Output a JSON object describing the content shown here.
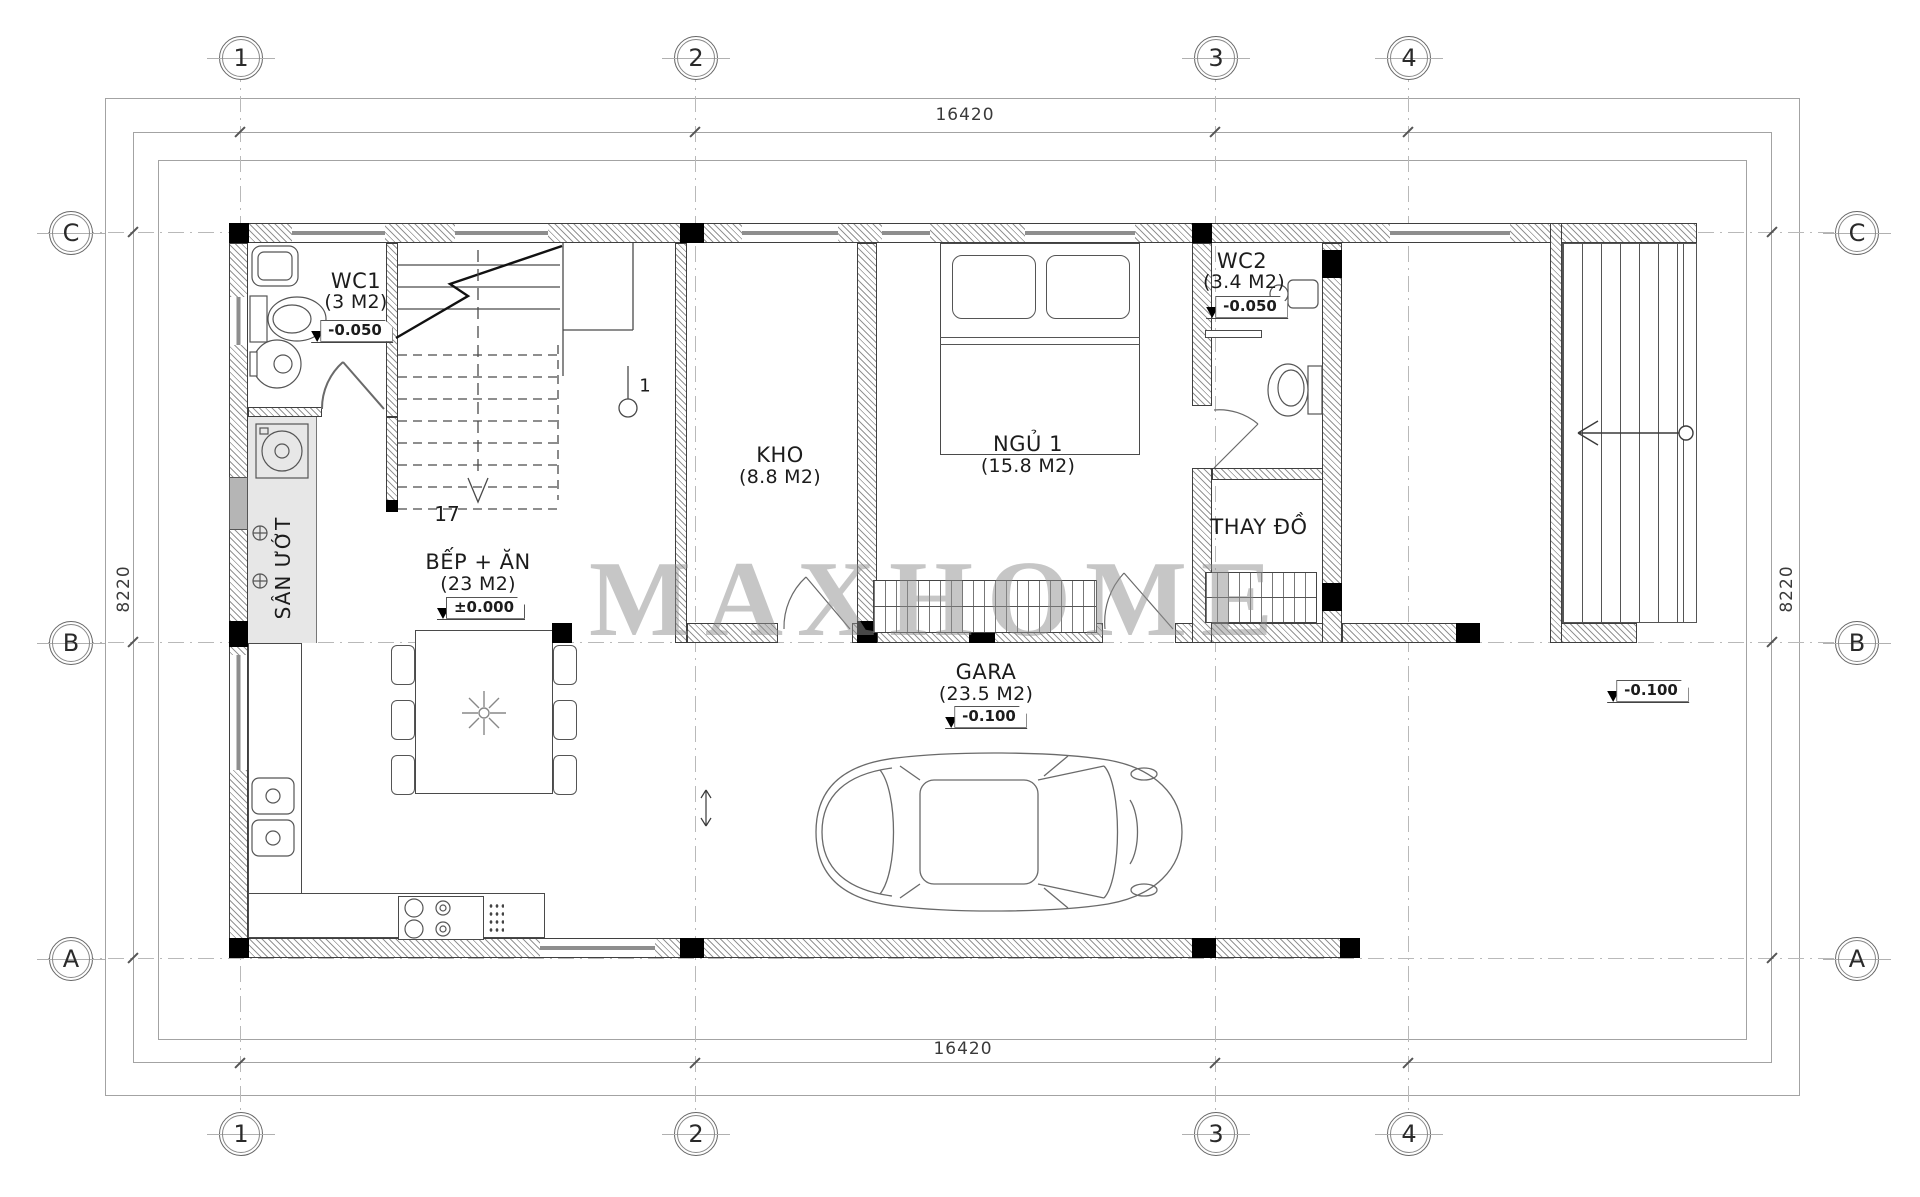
{
  "watermark": "MAXHOME",
  "grid": {
    "columns": [
      "1",
      "2",
      "3",
      "4"
    ],
    "rows": [
      "C",
      "B",
      "A"
    ]
  },
  "dimensions": {
    "top": "16420",
    "bottom": "16420",
    "left": "8220",
    "right": "8220"
  },
  "rooms": {
    "wc1": {
      "name": "WC1",
      "area": "(3 M2)",
      "elevation": "-0.050"
    },
    "kho": {
      "name": "KHO",
      "area": "(8.8 M2)"
    },
    "ngu1": {
      "name": "NGỦ 1",
      "area": "(15.8 M2)"
    },
    "wc2": {
      "name": "WC2",
      "area": "(3.4 M2)",
      "elevation": "-0.050"
    },
    "thay_do": {
      "name": "THAY ĐỒ"
    },
    "bep_an": {
      "name": "BẾP + ĂN",
      "area": "(23 M2)",
      "elevation": "±0.000"
    },
    "gara": {
      "name": "GARA",
      "area": "(23.5 M2)",
      "elevation": "-0.100"
    },
    "san_uot": {
      "name": "SÂN ƯỚT"
    }
  },
  "annotations": {
    "stair_riser_count": "17",
    "section_marker": "1",
    "yard_elevation": "-0.100"
  },
  "colors": {
    "line": "#3a3a3a",
    "grid_line": "#b9b9b9",
    "hatch": "#949494",
    "column": "#000000",
    "watermark": "#8f8f8f",
    "wet_floor": "#e7e7e7"
  }
}
